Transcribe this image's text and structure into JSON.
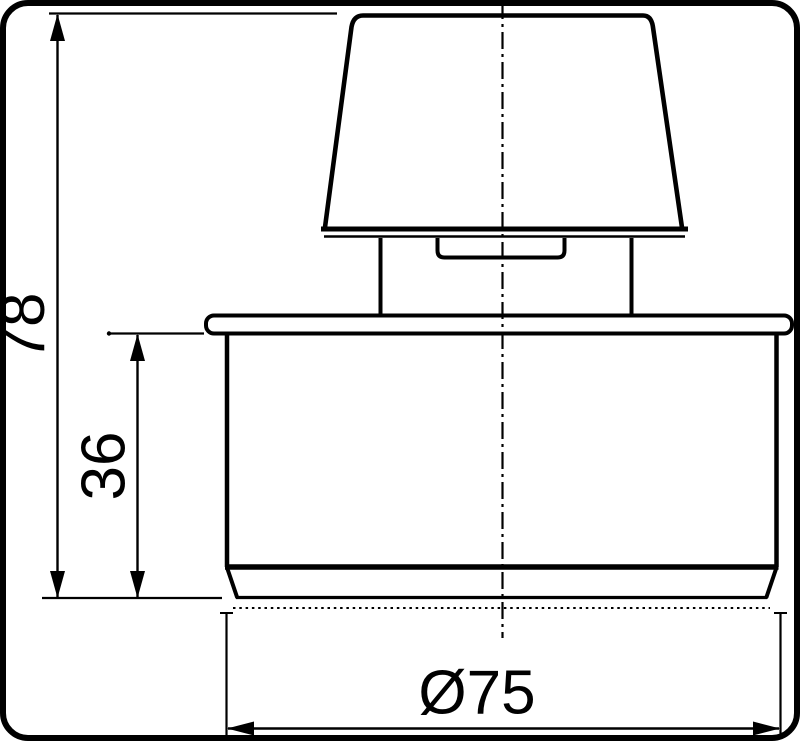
{
  "drawing": {
    "type": "technical-dimension-drawing",
    "ink_color": "#000000",
    "background_color": "#ffffff",
    "labels": {
      "height_total": "78",
      "height_body": "36",
      "diameter": "Ø75"
    }
  }
}
